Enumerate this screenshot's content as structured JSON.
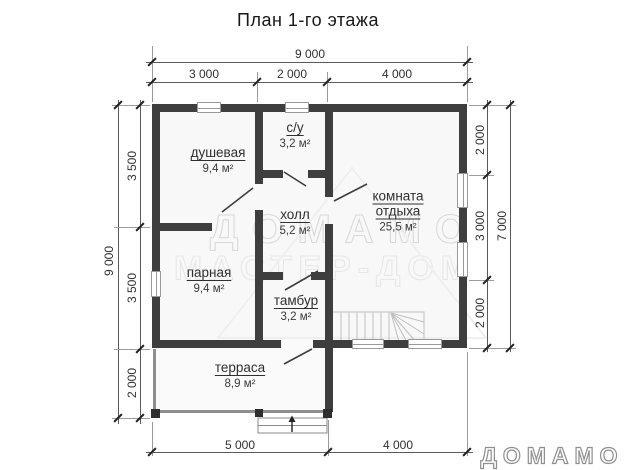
{
  "title": "План 1-го этажа",
  "rooms": [
    {
      "name": "душевая",
      "area": "9,4 м²"
    },
    {
      "name": "с/у",
      "area": "3,2 м²"
    },
    {
      "name": "холл",
      "area": "5,2 м²"
    },
    {
      "name": "комната отдыха",
      "area": "25,5 м²"
    },
    {
      "name": "парная",
      "area": "9,4 м²"
    },
    {
      "name": "тамбур",
      "area": "3,2 м²"
    },
    {
      "name": "терраса",
      "area": "8,9 м²"
    }
  ],
  "dimensions": {
    "top_overall": "9 000",
    "top_segments": [
      "3 000",
      "2 000",
      "4 000"
    ],
    "left_overall": "9 000",
    "left_segments": [
      "3 500",
      "3 500",
      "2 000"
    ],
    "right_overall": "7 000",
    "right_segments": [
      "2 000",
      "3 000",
      "2 000"
    ],
    "bottom_segments": [
      "5 000",
      "4 000"
    ]
  },
  "watermark": {
    "brand": "ДОМАМО",
    "sub": "МАСТЕР-ДОМ"
  },
  "logo_text": "ДОМАМО",
  "colors": {
    "wall": "#3e3e3e",
    "floor": "#f8f8f8",
    "dimension_text": "#2f2f2f",
    "label_text": "#2f2f2f",
    "watermark": "#dcdcdc",
    "logo_outline": "#8f8f8f"
  }
}
